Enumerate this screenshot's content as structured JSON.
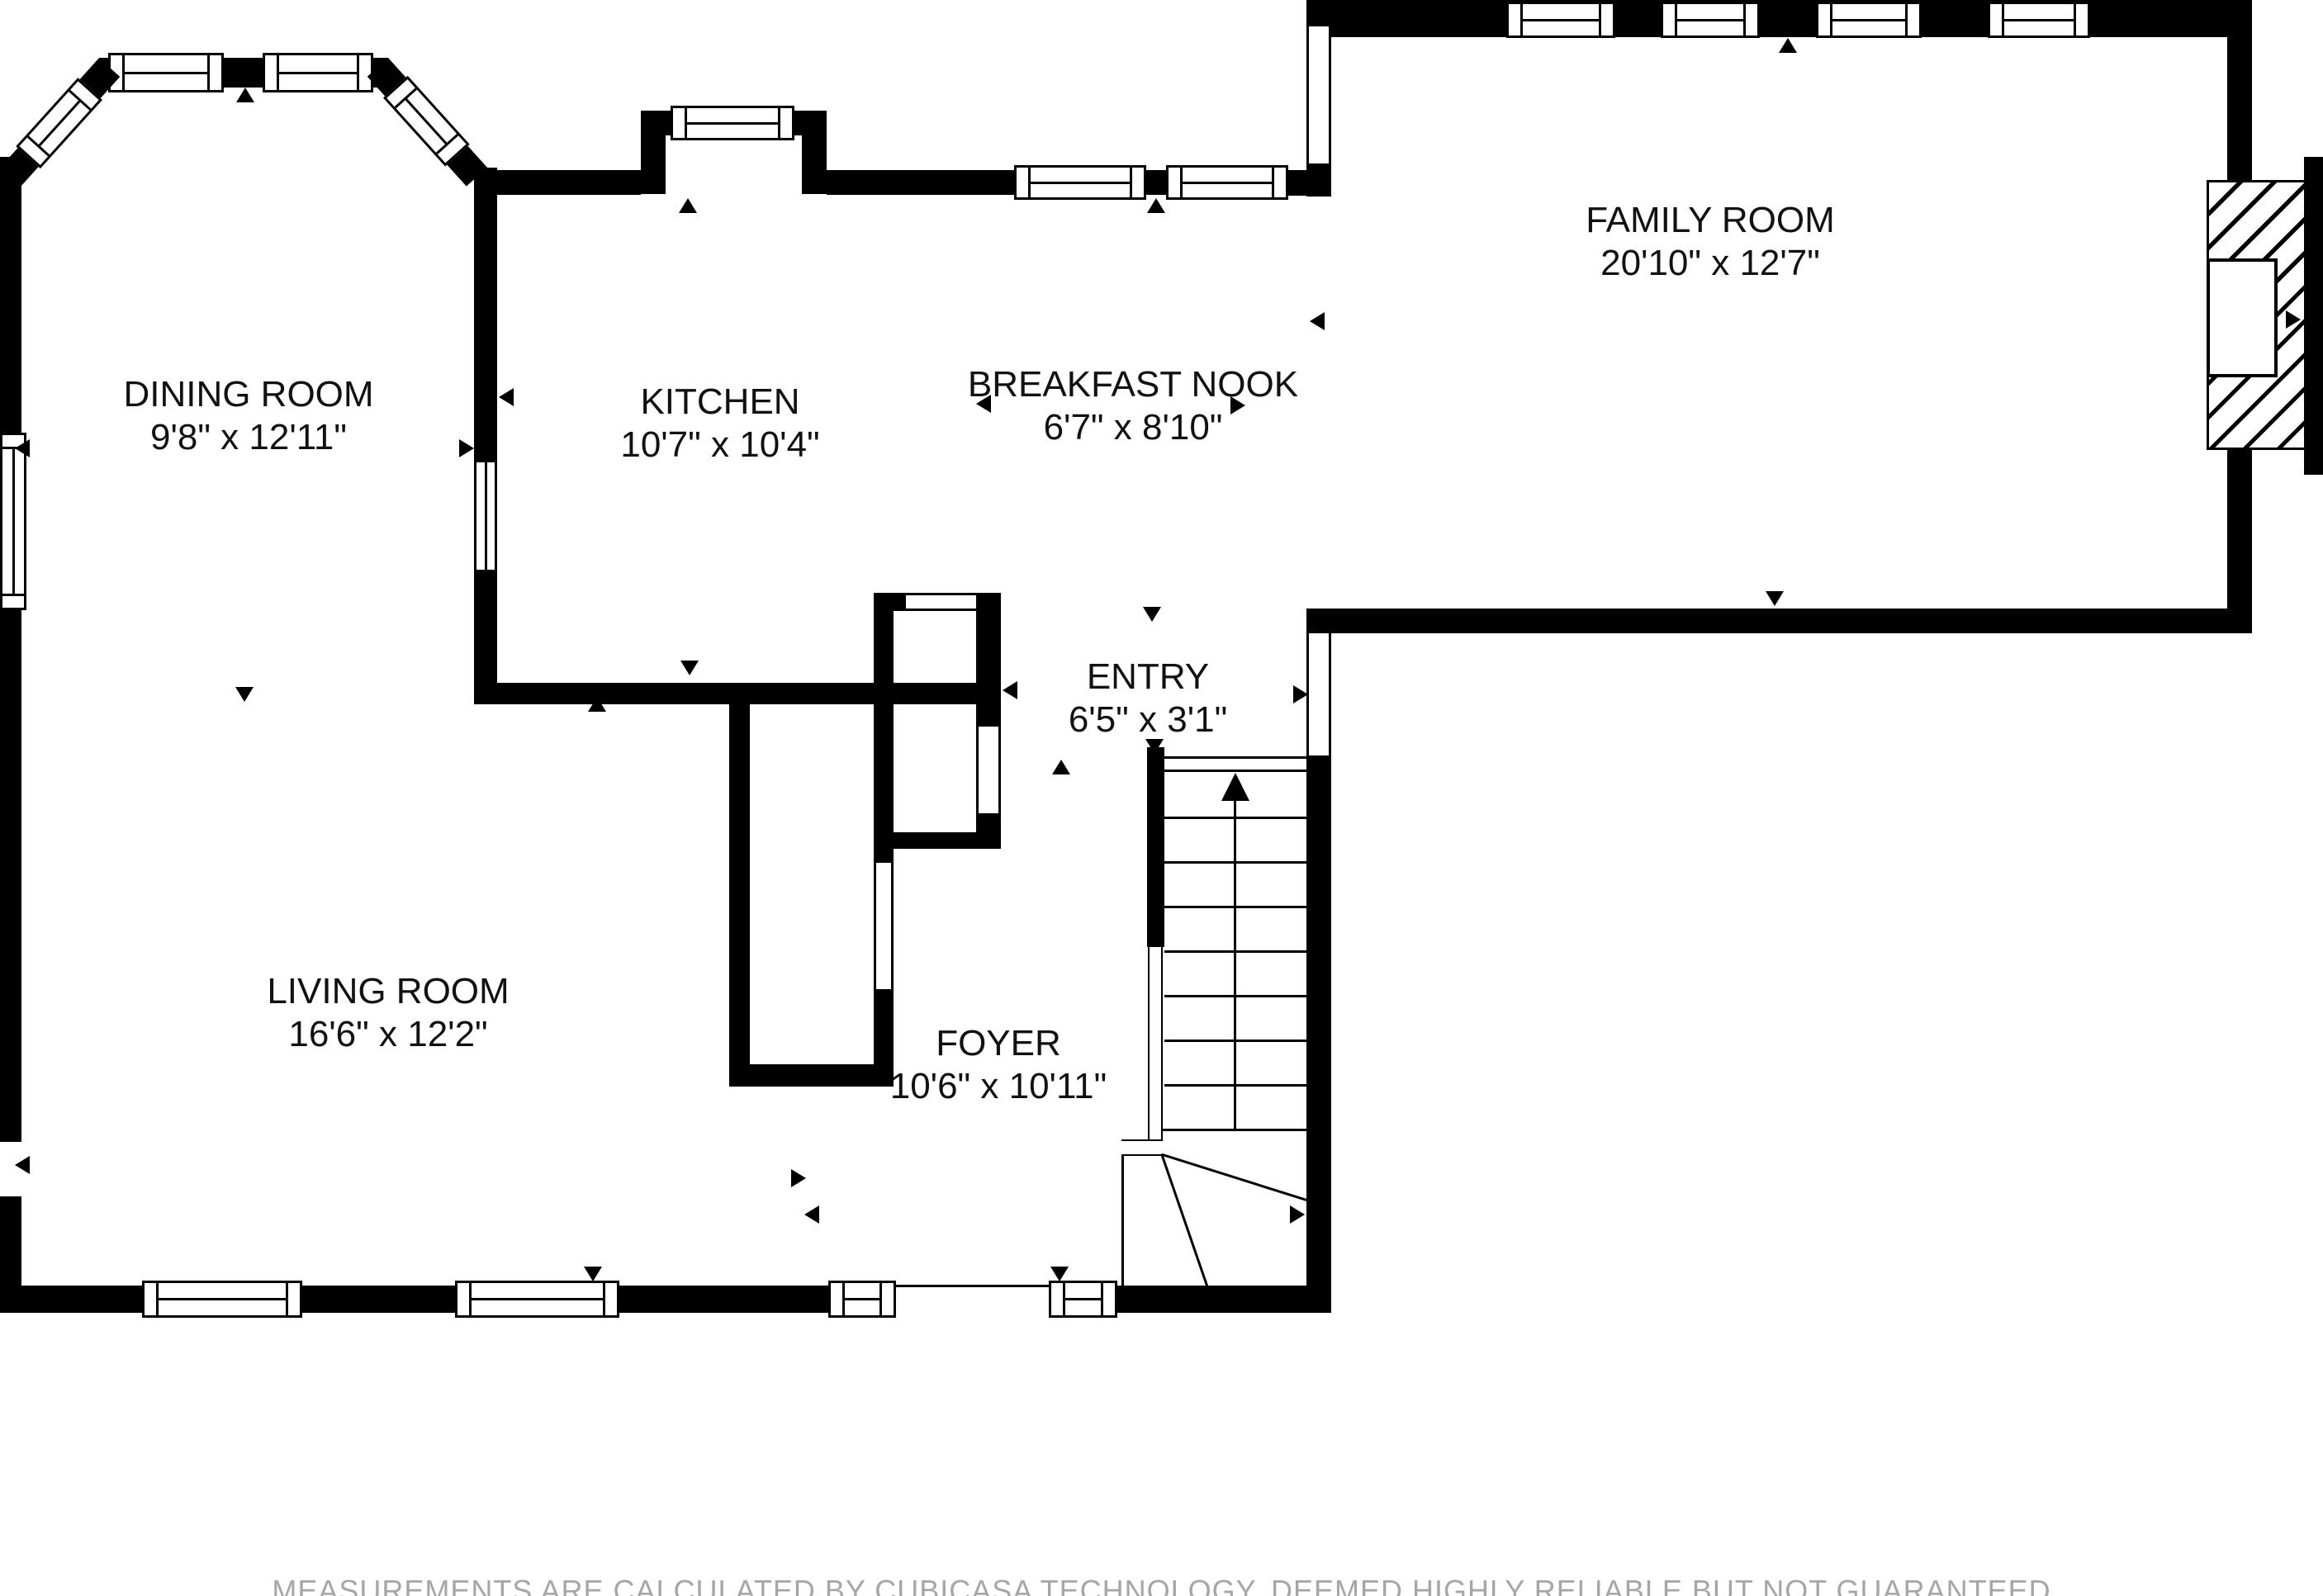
{
  "rooms": {
    "dining": {
      "name": "DINING ROOM",
      "dims": "9'8\" x 12'11\""
    },
    "kitchen": {
      "name": "KITCHEN",
      "dims": "10'7\" x 10'4\""
    },
    "nook": {
      "name": "BREAKFAST NOOK",
      "dims": "6'7\" x 8'10\""
    },
    "family": {
      "name": "FAMILY ROOM",
      "dims": "20'10\" x 12'7\""
    },
    "entry": {
      "name": "ENTRY",
      "dims": "6'5\" x 3'1\""
    },
    "living": {
      "name": "LIVING ROOM",
      "dims": "16'6\" x 12'2\""
    },
    "foyer": {
      "name": "FOYER",
      "dims": "10'6\" x 10'11\""
    }
  },
  "footer": {
    "disclaimer": "MEASUREMENTS ARE CALCULATED BY CUBICASA TECHNOLOGY, DEEMED HIGHLY RELIABLE BUT NOT GUARANTEED"
  },
  "colors": {
    "wall": "#000000",
    "background": "#ffffff",
    "disclaimer": "#a6a6a6"
  },
  "icons": {
    "stairs-up-arrow": "▲",
    "triangle-marker": "►",
    "window": "double-line-window",
    "fireplace": "hatched-box"
  },
  "stairs": {
    "direction": "up",
    "treads": 8,
    "winders": 3
  }
}
